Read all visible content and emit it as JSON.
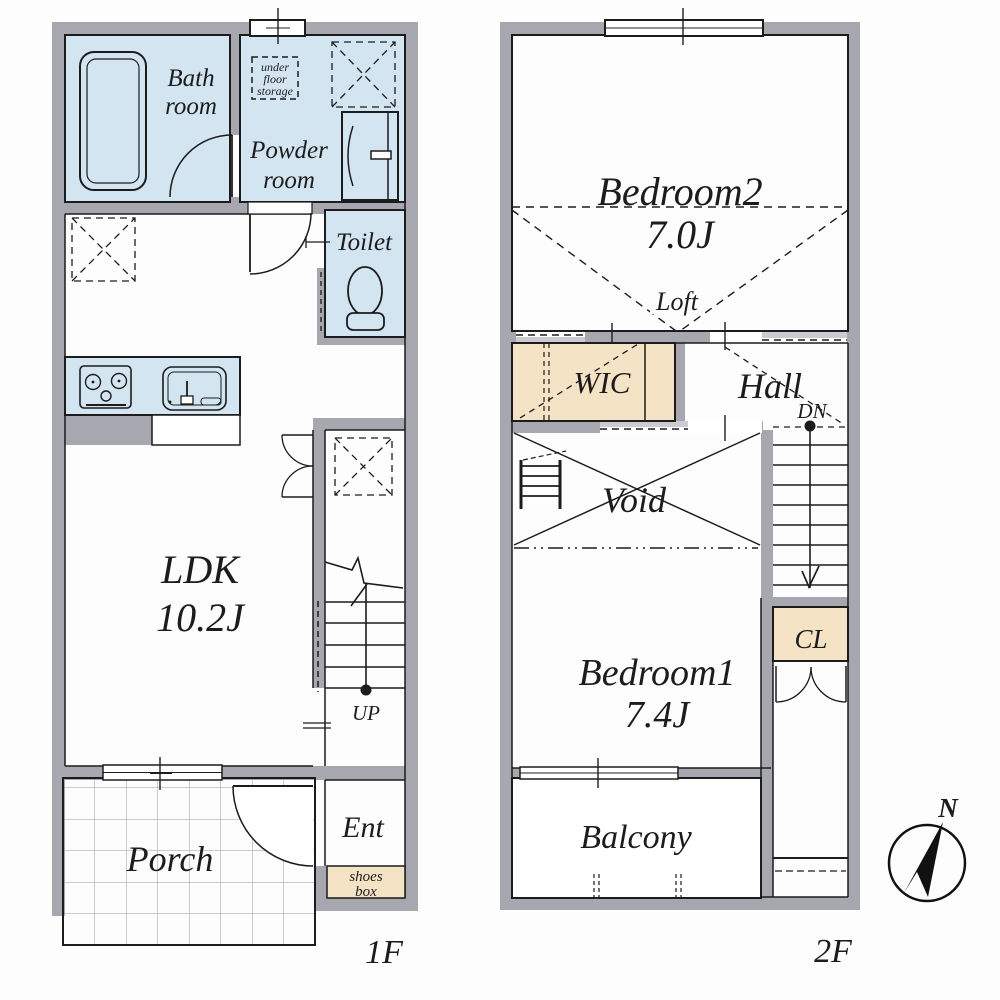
{
  "floor1": {
    "floor_label": "1F",
    "bath_line1": "Bath",
    "bath_line2": "room",
    "powder_line1": "Powder",
    "powder_line2": "room",
    "ufs_line1": "under",
    "ufs_line2": "floor",
    "ufs_line3": "storage",
    "toilet": "Toilet",
    "ldk_name": "LDK",
    "ldk_size": "10.2J",
    "up": "UP",
    "ent": "Ent",
    "shoes_line1": "shoes",
    "shoes_line2": "box",
    "porch": "Porch"
  },
  "floor2": {
    "floor_label": "2F",
    "bedroom2_name": "Bedroom2",
    "bedroom2_size": "7.0J",
    "loft": "Loft",
    "wic": "WIC",
    "hall": "Hall",
    "dn": "DN",
    "void": "Void",
    "bedroom1_name": "Bedroom1",
    "bedroom1_size": "7.4J",
    "cl": "CL",
    "balcony": "Balcony"
  },
  "compass": {
    "north": "N"
  },
  "colors": {
    "wall": "#a7a7af",
    "wall_light": "#cbcbd1",
    "room_blue": "#d4e5f2",
    "accent_tan": "#f5e3c5",
    "line": "#1c1c1c",
    "grid": "#9a9a9a"
  }
}
